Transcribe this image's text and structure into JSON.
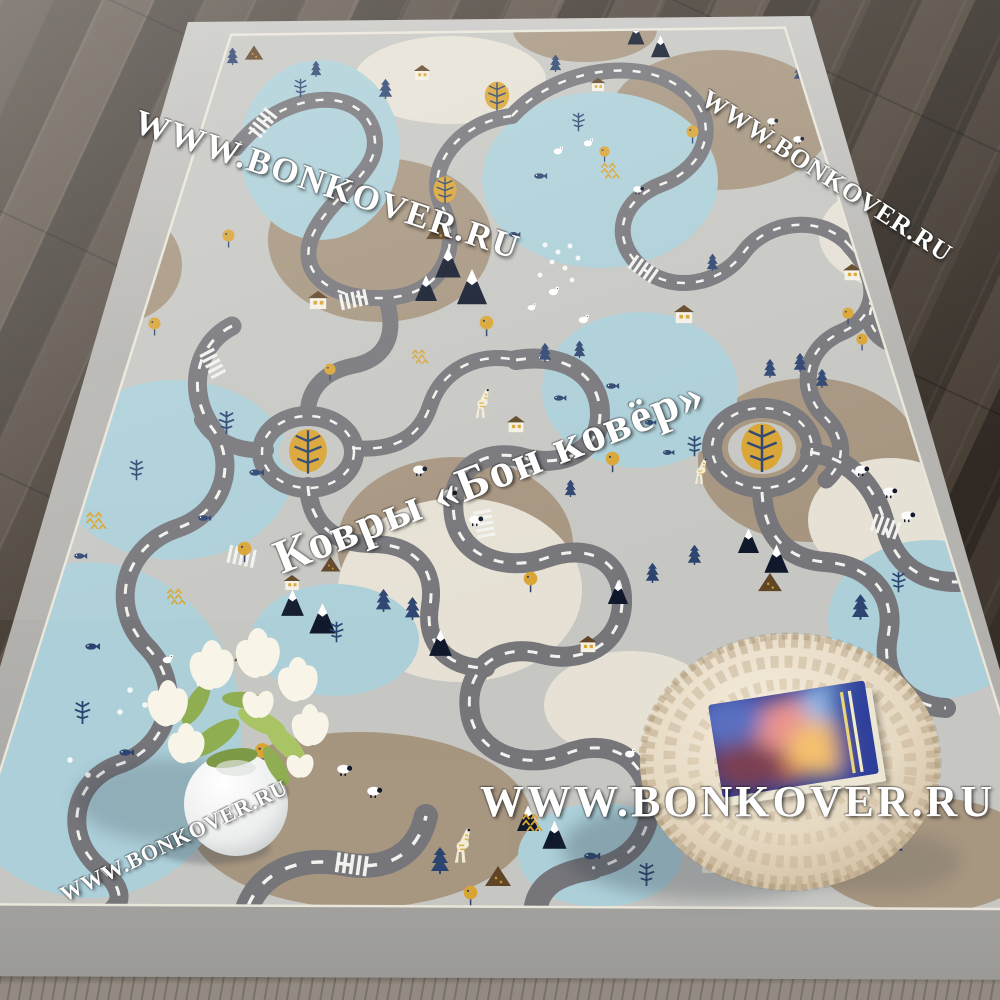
{
  "brand": {
    "site": "WWW.BONKOVER.RU",
    "store_name": "Ковры «Бон ковёр»"
  },
  "watermarks": {
    "top_left": "WWW.BONKOVER.RU",
    "top_right": "WWW.BONKOVER.RU",
    "center": "Ковры «Бон ковёр»",
    "bottom_center": "WWW.BONKOVER.RU",
    "bottom_left": "WWW.BONKOVER.RU"
  },
  "colors": {
    "floor-dark": "#453b33",
    "floor-light-strip": "#8a8177",
    "rug-border": "#b4b3af",
    "rug-piping": "#eae6da",
    "rug-base": "#c6c6c2",
    "patch-brown": "#a5937c",
    "patch-cream": "#e8e3d6",
    "lake-blue": "#abd0da",
    "road-gray": "#75757a",
    "road-dash": "#f2f2ee",
    "navy": "#2c4470",
    "ink": "#10192b",
    "mustard": "#d9a433",
    "dark-brown": "#5f4526",
    "house-white": "#f4f0e4",
    "pouf-cream": "#e9dfcc",
    "book-blue": "#2d3f9b",
    "book-stripe": "#e8d47c",
    "flower-white": "#f8f5e8",
    "leaf-green": "#8fae52",
    "watermark-white": "#ffffff"
  }
}
